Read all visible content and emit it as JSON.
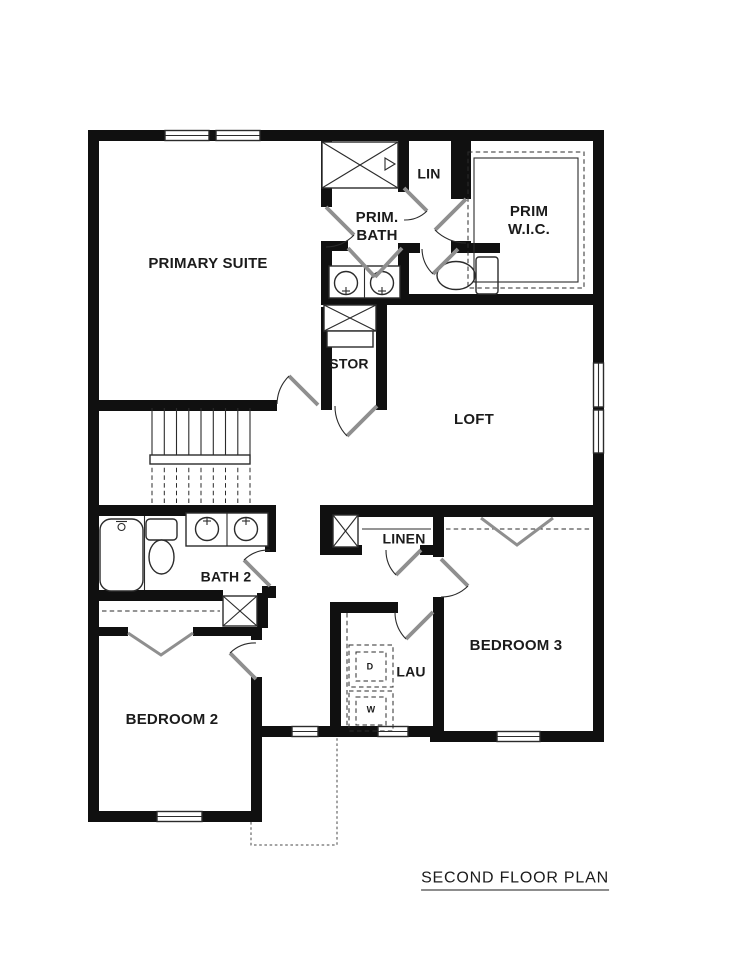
{
  "page": {
    "title": "SECOND FLOOR PLAN"
  },
  "rooms": {
    "primary_suite": "PRIMARY SUITE",
    "prim_bath": "PRIM. BATH",
    "lin": "LIN",
    "prim_wic": "PRIM W.I.C.",
    "stor": "STOR",
    "loft": "LOFT",
    "bath2": "BATH 2",
    "linen": "LINEN",
    "bedroom2": "BEDROOM 2",
    "bedroom3": "BEDROOM 3",
    "laundry": "LAU"
  },
  "appliances": {
    "dryer": "D",
    "washer": "W"
  },
  "colors": {
    "wall": "#101010",
    "line": "#2b2b2b",
    "door_leaf": "#8f8f8f",
    "background": "#ffffff",
    "text": "#1b1b1b"
  }
}
